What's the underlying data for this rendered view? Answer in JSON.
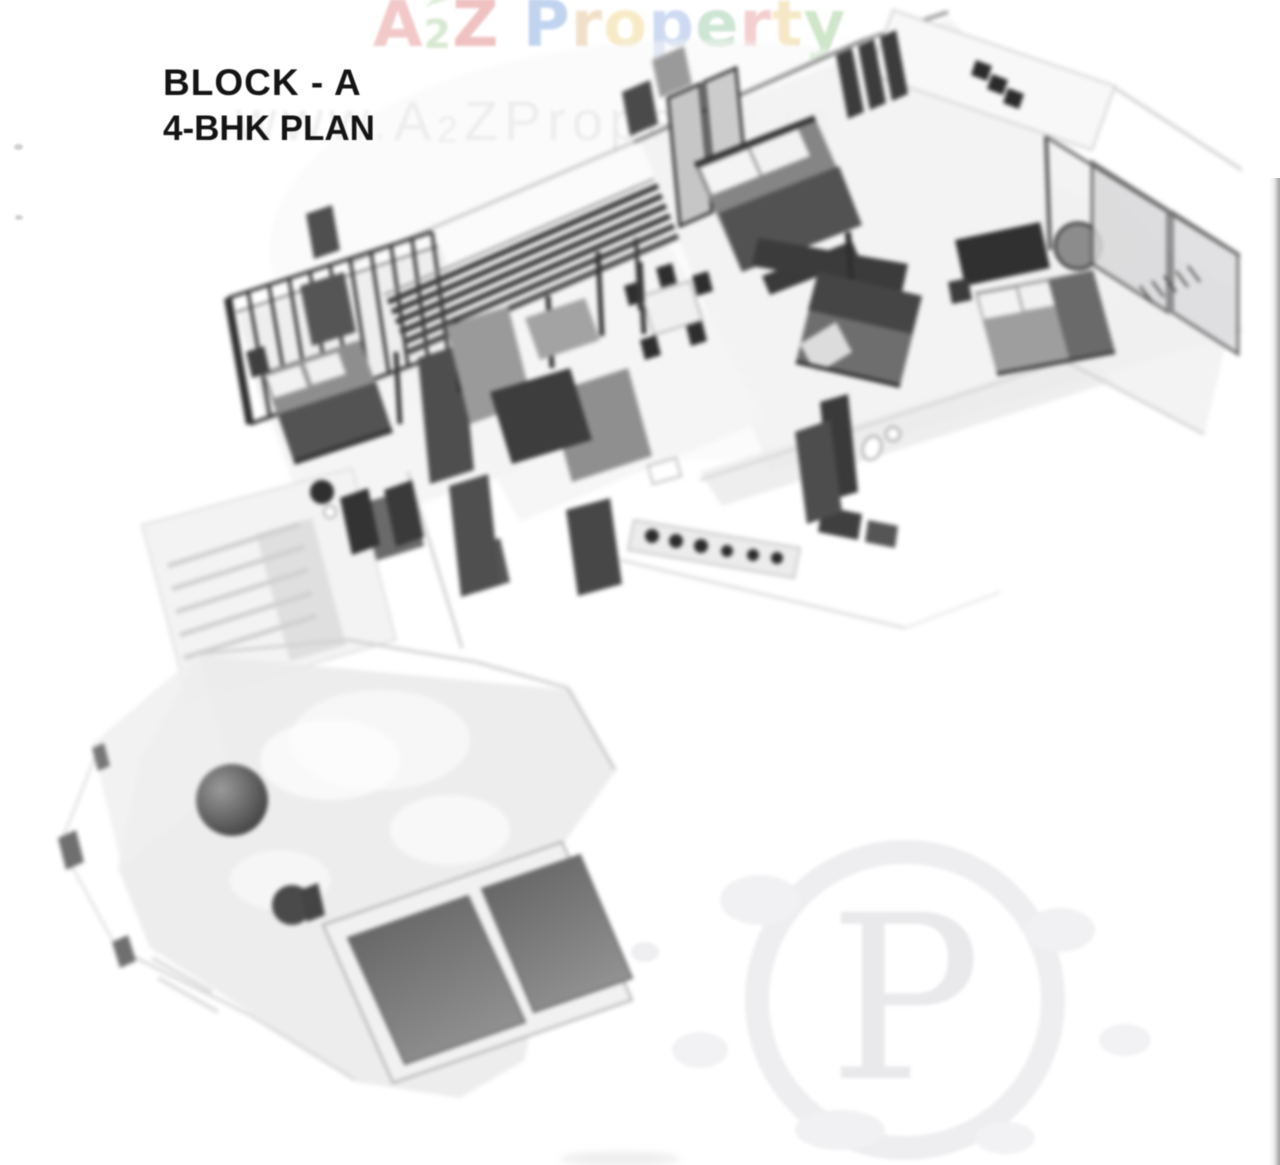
{
  "page": {
    "background": "#ffffff",
    "right_edge_line_color": "#a8a8a8",
    "speck_color": "#cfcfcf"
  },
  "logo": {
    "text": "A2Z Property",
    "leaf_color": "#aed0a0",
    "letters": [
      {
        "ch": "A",
        "color": "#e89c9c",
        "small": false
      },
      {
        "ch": "2",
        "color": "#b7d7ae",
        "small": true
      },
      {
        "ch": "Z",
        "color": "#e49090",
        "small": false
      },
      {
        "ch": " ",
        "color": "#ffffff",
        "small": false
      },
      {
        "ch": "P",
        "color": "#8fb2e2",
        "small": false
      },
      {
        "ch": "r",
        "color": "#e6c79e",
        "small": false
      },
      {
        "ch": "o",
        "color": "#f1db9b",
        "small": false
      },
      {
        "ch": "p",
        "color": "#a6bde8",
        "small": false
      },
      {
        "ch": "e",
        "color": "#a5d0b0",
        "small": false
      },
      {
        "ch": "r",
        "color": "#eaa8a8",
        "small": false
      },
      {
        "ch": "t",
        "color": "#efd79a",
        "small": false
      },
      {
        "ch": "y",
        "color": "#a8d2a0",
        "small": false
      }
    ]
  },
  "titles": {
    "block_label": "BLOCK - A",
    "plan_label": "4-BHK PLAN",
    "color": "#141414"
  },
  "watermark": {
    "p0": "www.",
    "p1": "A",
    "p2": "2",
    "p3": "ZProperty.in",
    "color": "#e3e3e6"
  },
  "seal": {
    "letter": "P",
    "color": "#e9e9ec"
  },
  "plan_palette": {
    "wall_shadow": "#d8d8d8",
    "floor_light": "#f3f3f3",
    "furniture_dark": "#3a3a3a",
    "furniture_mid": "#8a8a8a",
    "terrace": "#ebebeb",
    "tank_fill": "#777777",
    "glass": "#d8d8da",
    "railing": "#383838"
  }
}
